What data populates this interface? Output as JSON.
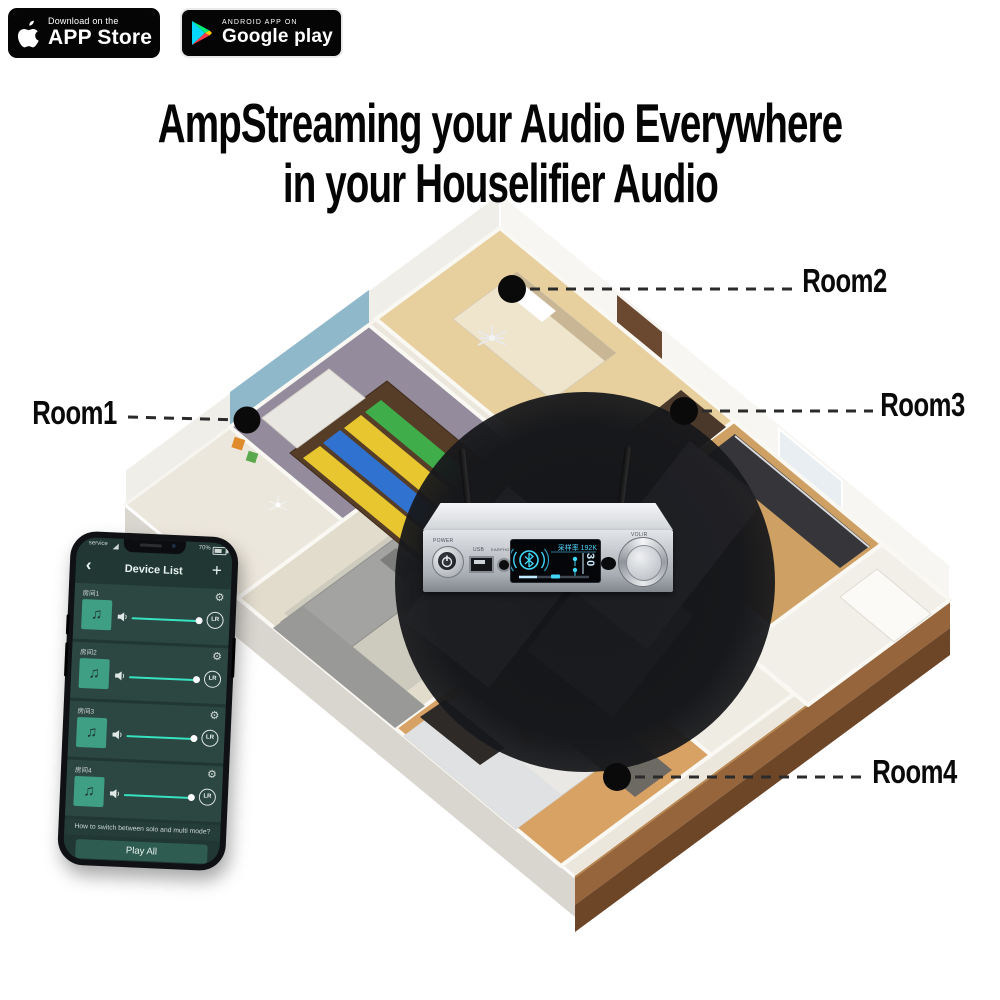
{
  "badges": {
    "app_store": {
      "tagline": "Download on the",
      "store": "APP Store"
    },
    "google_play": {
      "tagline": "ANDROID APP ON",
      "store": "Google play"
    }
  },
  "headline": {
    "line1": "AmpStreaming your Audio Everywhere",
    "line2": "in your Houselifier Audio"
  },
  "room_labels": {
    "room1": "Room1",
    "room2": "Room2",
    "room3": "Room3",
    "room4": "Room4"
  },
  "device_panel": {
    "power_label": "POWER",
    "usb_label": "USB",
    "earphone_label": "EARPHONE",
    "volume_label": "VOL/R",
    "display": {
      "sample_rate": "采样率 192K",
      "volume": "30"
    }
  },
  "phone": {
    "status": {
      "carrier": "service",
      "battery": "70%"
    },
    "header": {
      "back": "‹",
      "title": "Device List",
      "add": "+"
    },
    "rooms": [
      {
        "name": "房间1",
        "channel": "LR"
      },
      {
        "name": "房间2",
        "channel": "LR"
      },
      {
        "name": "房间3",
        "channel": "LR"
      },
      {
        "name": "房间4",
        "channel": "LR"
      }
    ],
    "hint": "How to switch between solo and multi mode?",
    "play_all": "Play All",
    "icons": {
      "gear": "⚙",
      "note": "♫"
    }
  },
  "colors": {
    "accent_teal": "#36e2c0",
    "display_blue": "#4fd8ff",
    "badge_bg": "#050505",
    "wood_wall": "#8a5a35"
  }
}
